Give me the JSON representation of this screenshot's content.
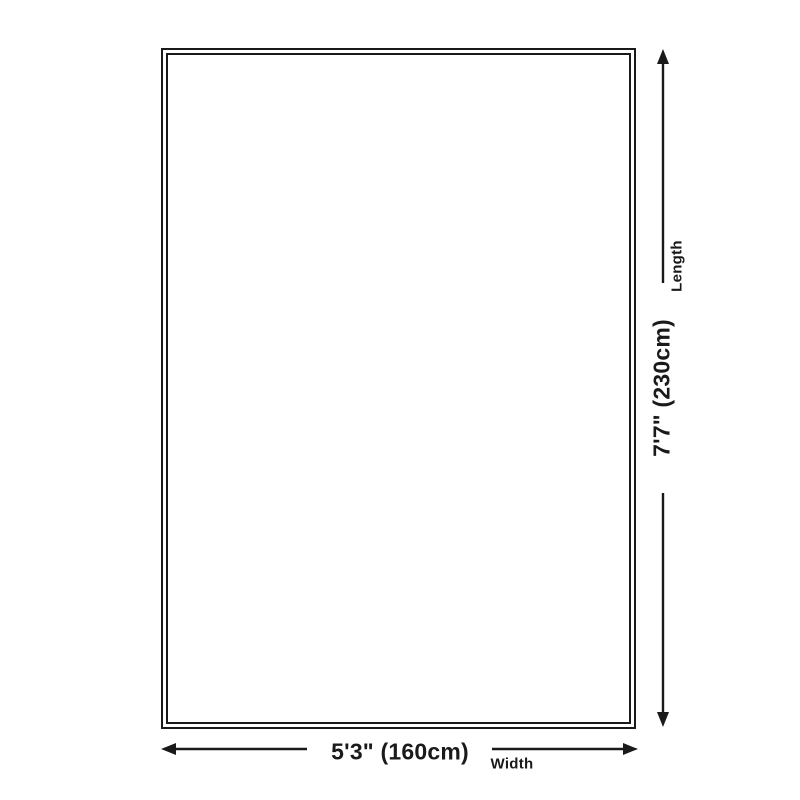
{
  "diagram": {
    "title": "rug-size-dimension-diagram",
    "width_dimension": {
      "value": "5'3\" (160cm)",
      "label": "Width"
    },
    "length_dimension": {
      "value": "7'7\" (230cm)",
      "label": "Length"
    },
    "colors": {
      "line": "#1a1a1a",
      "background": "#ffffff"
    }
  }
}
